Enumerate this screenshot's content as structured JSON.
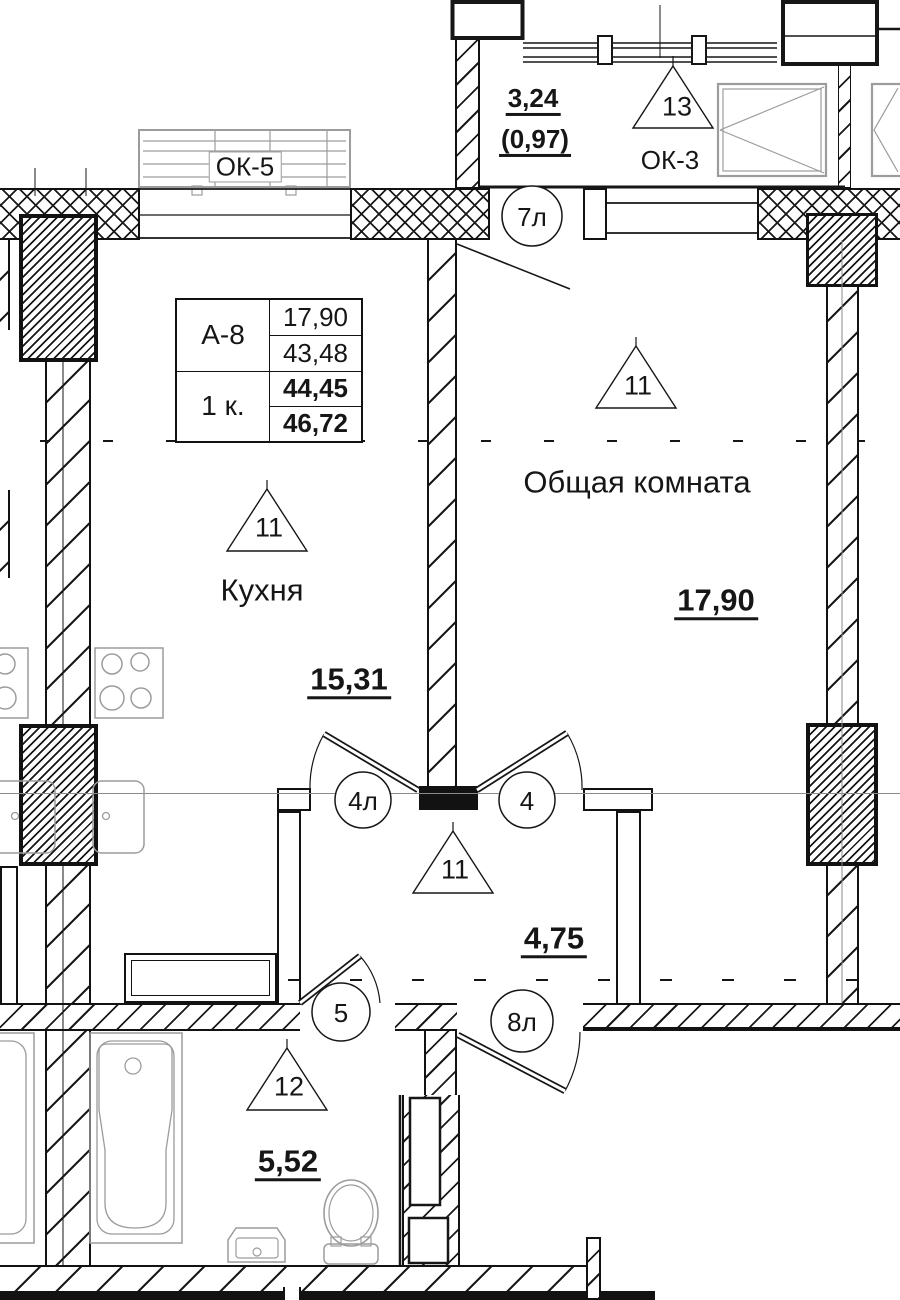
{
  "drawing": {
    "info_table": {
      "unit": "А-8",
      "unit_type": "1 к.",
      "room_area": "17,90",
      "living_area": "43,48",
      "area_wo_balcony": "44,45",
      "total_area": "46,72"
    },
    "balcony": {
      "marker": "13",
      "area": "3,24",
      "area_coeff": "(0,97)",
      "window": "ОК-3"
    },
    "kitchen": {
      "marker": "11",
      "name": "Кухня",
      "area": "15,31",
      "window": "ОК-5"
    },
    "living_room": {
      "marker": "11",
      "name": "Общая комната",
      "area": "17,90"
    },
    "hall": {
      "marker": "11",
      "area": "4,75"
    },
    "bathroom": {
      "marker": "12",
      "area": "5,52"
    },
    "doors": {
      "balcony_door": "7л",
      "kitchen_door": "4л",
      "living_door": "4",
      "bathroom_door": "5",
      "entrance_door": "8л"
    },
    "colors": {
      "ink": "#161616",
      "fixture": "#9c9c9c"
    }
  }
}
